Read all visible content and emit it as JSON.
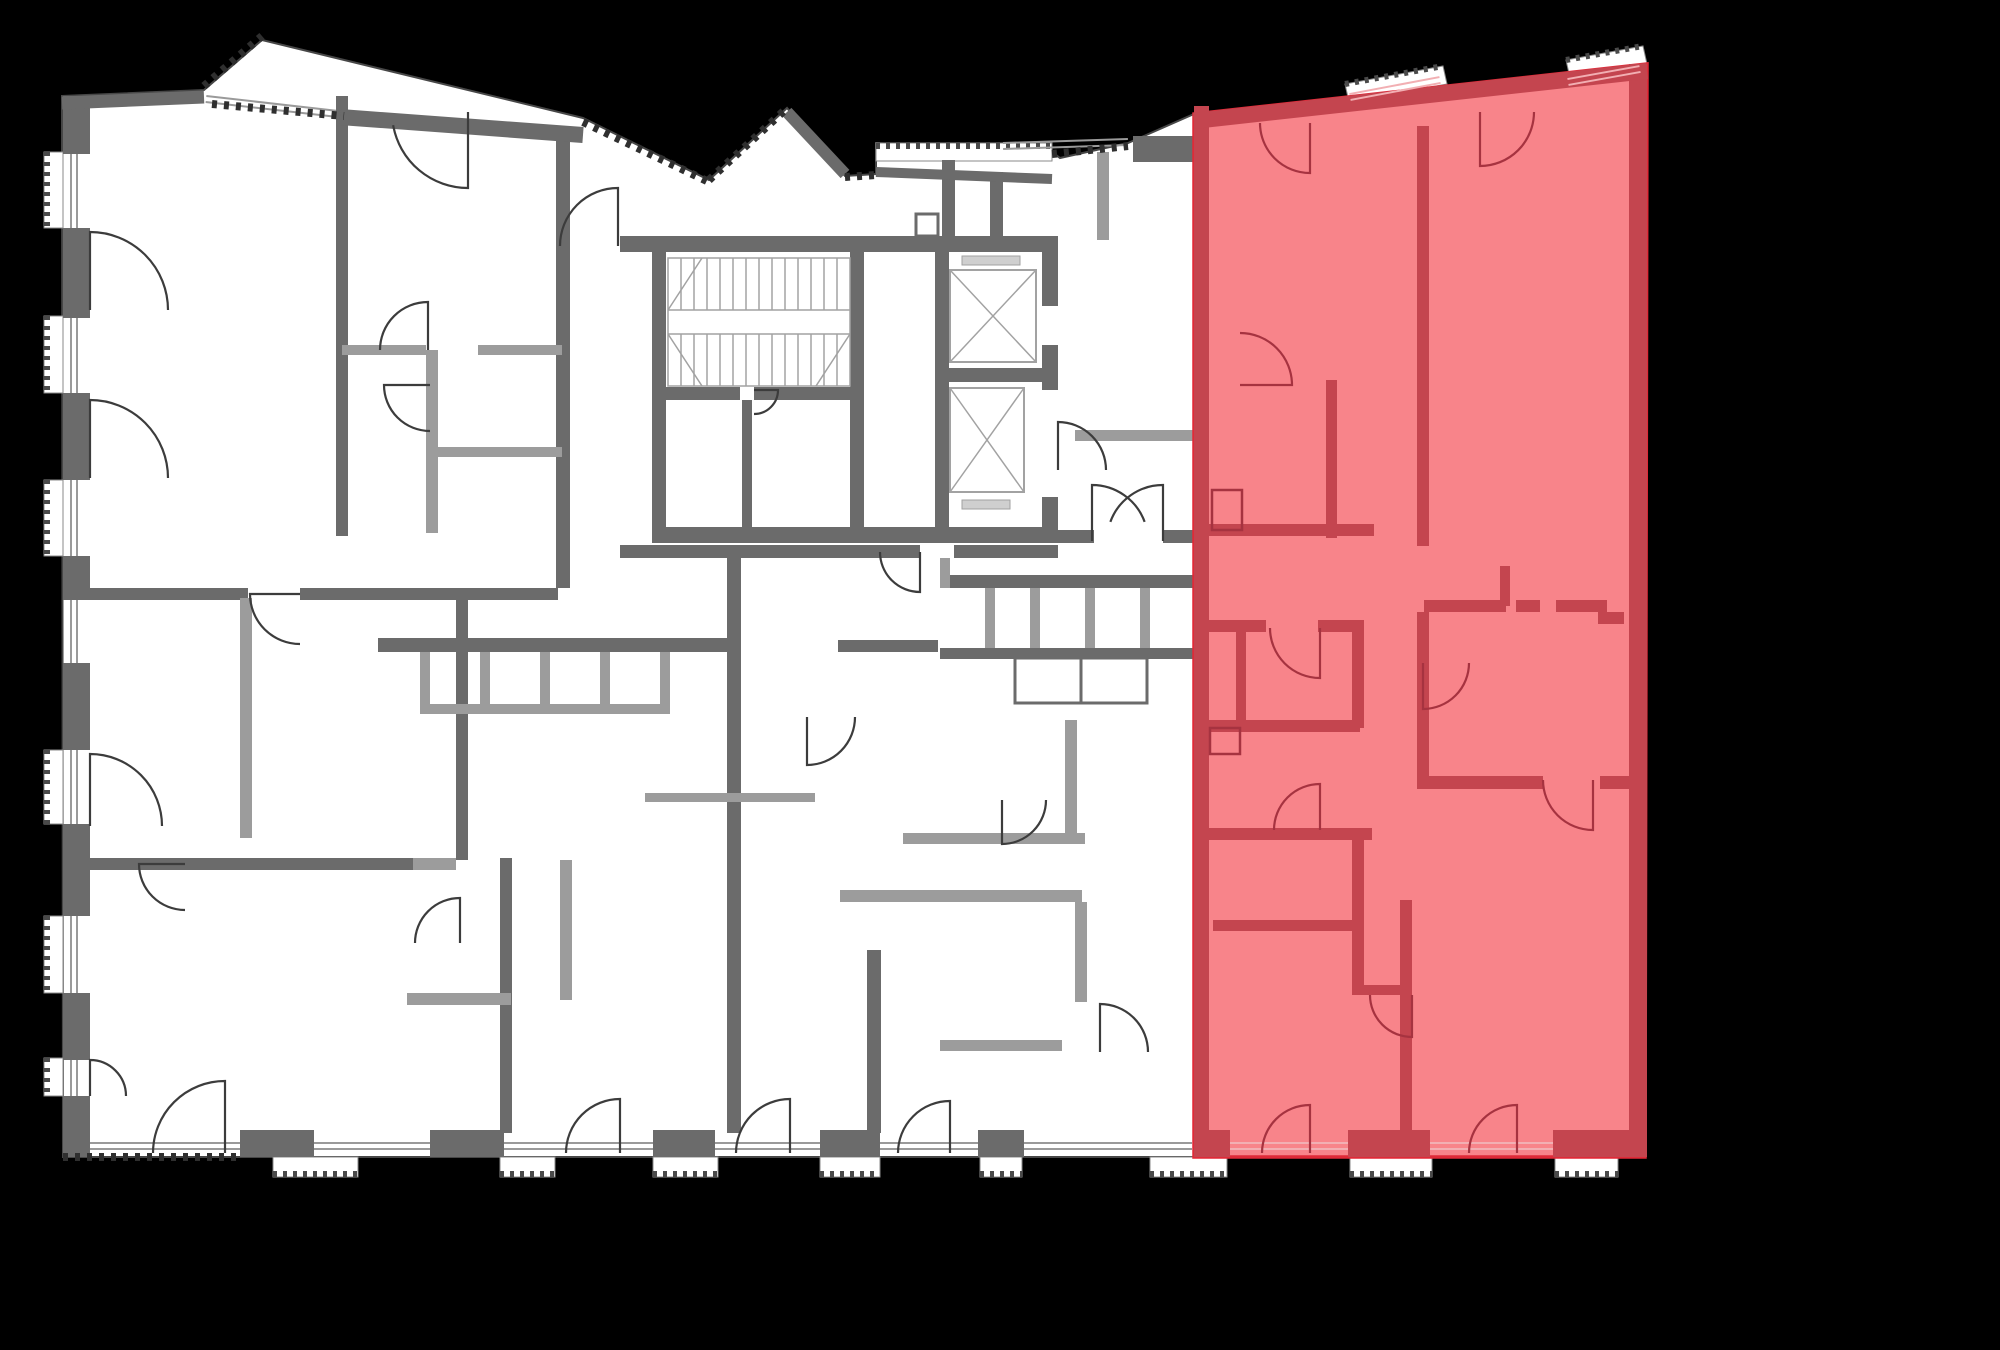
{
  "meta": {
    "title": "Residential building floor plan with selected apartment highlighted",
    "selected_unit_label": "selected-apartment",
    "canvas_width": 2000,
    "canvas_height": 1350
  },
  "palette": {
    "background": "#000000",
    "floor": "#ffffff",
    "outline": "#474747",
    "wall_dark": "#6b6b6b",
    "wall_light": "#9c9c9c",
    "glass": "#9a9a9a",
    "tick": "#2f2f2f",
    "balcony_tick": "#4a4a4a",
    "stair_line": "#a2a2a2",
    "door_line": "#3c3c3c",
    "hl_floor": "#F87F85",
    "hl_wall": "#C4454F",
    "hl_line": "#A63340",
    "hl_edge": "#E02A38",
    "hl_glass": "#F2AFB3"
  },
  "floor": {
    "outline": [
      [
        62,
        96
      ],
      [
        204,
        90
      ],
      [
        262,
        40
      ],
      [
        583,
        118
      ],
      [
        709,
        180
      ],
      [
        787,
        108
      ],
      [
        845,
        176
      ],
      [
        876,
        174
      ],
      [
        876,
        143
      ],
      [
        1052,
        152
      ],
      [
        1060,
        158
      ],
      [
        1128,
        143
      ],
      [
        1194,
        114
      ],
      [
        1647,
        64
      ],
      [
        1645,
        1157
      ],
      [
        63,
        1157
      ]
    ]
  },
  "walls": {
    "dark": [
      [
        63,
        96,
        27,
        58
      ],
      [
        63,
        228,
        27,
        90
      ],
      [
        63,
        393,
        27,
        87
      ],
      [
        63,
        556,
        27,
        36
      ],
      [
        63,
        663,
        27,
        87
      ],
      [
        63,
        824,
        27,
        92
      ],
      [
        63,
        993,
        27,
        67
      ],
      [
        63,
        1096,
        27,
        61
      ],
      [
        240,
        1130,
        74,
        27
      ],
      [
        430,
        1130,
        74,
        27
      ],
      [
        653,
        1130,
        62,
        27
      ],
      [
        820,
        1130,
        60,
        27
      ],
      [
        978,
        1130,
        46,
        27
      ],
      [
        620,
        236,
        438,
        16
      ],
      [
        652,
        252,
        14,
        275
      ],
      [
        850,
        252,
        14,
        275
      ],
      [
        652,
        527,
        406,
        16
      ],
      [
        652,
        387,
        88,
        13
      ],
      [
        754,
        387,
        96,
        13
      ],
      [
        742,
        400,
        10,
        127
      ],
      [
        935,
        252,
        14,
        275
      ],
      [
        1042,
        236,
        16,
        70
      ],
      [
        1042,
        345,
        16,
        45
      ],
      [
        1042,
        497,
        16,
        30
      ],
      [
        935,
        368,
        123,
        14
      ],
      [
        942,
        160,
        13,
        84
      ],
      [
        990,
        172,
        13,
        72
      ],
      [
        1133,
        136,
        60,
        26
      ],
      [
        620,
        545,
        300,
        13
      ],
      [
        954,
        545,
        104,
        13
      ],
      [
        1058,
        530,
        36,
        13
      ],
      [
        1163,
        530,
        31,
        13
      ],
      [
        727,
        558,
        14,
        575
      ],
      [
        336,
        96,
        12,
        440
      ],
      [
        556,
        128,
        14,
        460
      ],
      [
        456,
        598,
        12,
        262
      ],
      [
        500,
        858,
        12,
        275
      ],
      [
        867,
        950,
        14,
        183
      ],
      [
        378,
        638,
        352,
        14
      ],
      [
        838,
        640,
        100,
        12
      ],
      [
        940,
        575,
        254,
        13
      ],
      [
        940,
        648,
        254,
        11
      ],
      [
        63,
        588,
        185,
        12
      ],
      [
        300,
        588,
        258,
        12
      ],
      [
        63,
        858,
        350,
        12
      ]
    ],
    "light": [
      [
        342,
        345,
        84,
        10
      ],
      [
        478,
        345,
        84,
        10
      ],
      [
        426,
        350,
        12,
        183
      ],
      [
        432,
        447,
        130,
        10
      ],
      [
        240,
        598,
        12,
        240
      ],
      [
        407,
        993,
        104,
        12
      ],
      [
        560,
        860,
        12,
        140
      ],
      [
        413,
        858,
        43,
        12
      ],
      [
        985,
        588,
        10,
        60
      ],
      [
        1030,
        588,
        10,
        60
      ],
      [
        1085,
        588,
        10,
        60
      ],
      [
        1140,
        588,
        10,
        60
      ],
      [
        420,
        652,
        10,
        58
      ],
      [
        480,
        652,
        10,
        58
      ],
      [
        540,
        652,
        10,
        58
      ],
      [
        600,
        652,
        10,
        58
      ],
      [
        660,
        652,
        10,
        58
      ],
      [
        420,
        704,
        250,
        10
      ],
      [
        840,
        890,
        242,
        12
      ],
      [
        1075,
        902,
        12,
        100
      ],
      [
        903,
        833,
        182,
        11
      ],
      [
        1065,
        720,
        12,
        115
      ],
      [
        940,
        1040,
        122,
        11
      ],
      [
        1097,
        152,
        12,
        88
      ],
      [
        1075,
        430,
        119,
        11
      ],
      [
        645,
        793,
        170,
        9
      ],
      [
        940,
        558,
        10,
        30
      ]
    ],
    "thick_lines": [
      [
        62,
        103,
        204,
        97,
        13
      ],
      [
        340,
        117,
        583,
        135,
        16
      ],
      [
        787,
        112,
        845,
        174,
        12
      ],
      [
        876,
        172,
        1052,
        179,
        10
      ]
    ],
    "boxes": [
      [
        916,
        214,
        22,
        22
      ],
      [
        1015,
        658,
        66,
        45
      ],
      [
        1081,
        658,
        66,
        45
      ]
    ]
  },
  "openings": {
    "windows": [
      [
        74,
        152,
        74,
        228
      ],
      [
        74,
        316,
        74,
        393
      ],
      [
        74,
        480,
        74,
        556
      ],
      [
        74,
        592,
        74,
        663
      ],
      [
        74,
        750,
        74,
        824
      ],
      [
        74,
        916,
        74,
        993
      ],
      [
        74,
        1060,
        74,
        1096
      ],
      [
        206,
        99,
        338,
        114
      ],
      [
        1003,
        146,
        1128,
        142
      ],
      [
        90,
        1146,
        240,
        1146
      ],
      [
        314,
        1146,
        430,
        1146
      ],
      [
        504,
        1146,
        653,
        1146
      ],
      [
        715,
        1146,
        820,
        1146
      ],
      [
        880,
        1146,
        978,
        1146
      ],
      [
        1024,
        1146,
        1192,
        1146
      ]
    ]
  },
  "balconies": {
    "rects": [
      [
        44,
        152,
        19,
        76,
        "left"
      ],
      [
        44,
        316,
        19,
        77,
        "left"
      ],
      [
        44,
        480,
        19,
        76,
        "left"
      ],
      [
        44,
        750,
        19,
        74,
        "left"
      ],
      [
        44,
        916,
        19,
        77,
        "left"
      ],
      [
        44,
        1058,
        19,
        38,
        "left"
      ],
      [
        273,
        1157,
        85,
        20,
        "bottom"
      ],
      [
        500,
        1157,
        55,
        20,
        "bottom"
      ],
      [
        653,
        1157,
        65,
        20,
        "bottom"
      ],
      [
        820,
        1157,
        60,
        20,
        "bottom"
      ],
      [
        980,
        1157,
        42,
        20,
        "bottom"
      ],
      [
        1150,
        1157,
        77,
        20,
        "bottom"
      ],
      [
        1350,
        1157,
        82,
        20,
        "bottom"
      ],
      [
        1555,
        1157,
        63,
        20,
        "bottom"
      ],
      [
        876,
        143,
        176,
        18,
        "top"
      ]
    ],
    "quads": [
      [
        [
          1345,
          84
        ],
        [
          1443,
          66
        ],
        [
          1447,
          84
        ],
        [
          1349,
          102
        ]
      ],
      [
        [
          1566,
          60
        ],
        [
          1643,
          46
        ],
        [
          1647,
          64
        ],
        [
          1570,
          78
        ]
      ]
    ]
  },
  "ticks": [
    [
      204,
      86,
      262,
      36
    ],
    [
      212,
      104,
      344,
      116
    ],
    [
      583,
      122,
      709,
      182
    ],
    [
      709,
      180,
      787,
      108
    ],
    [
      845,
      177,
      876,
      175
    ],
    [
      1052,
      154,
      1128,
      146
    ],
    [
      63,
      1157,
      240,
      1157
    ]
  ],
  "stairs": {
    "x": 668,
    "y": 258,
    "w": 182,
    "flight": 52,
    "gap": 24,
    "treads": 13
  },
  "elevators": [
    {
      "inner": [
        950,
        270,
        86,
        92
      ],
      "sill": [
        962,
        256,
        58,
        9
      ]
    },
    {
      "inner": [
        950,
        388,
        74,
        104
      ],
      "sill": [
        962,
        500,
        48,
        9
      ]
    }
  ],
  "doors": {
    "gray": [
      {
        "h": [
          90,
          310
        ],
        "r": 78,
        "a": -90,
        "b": 0
      },
      {
        "h": [
          90,
          478
        ],
        "r": 78,
        "a": -90,
        "b": 0
      },
      {
        "h": [
          90,
          826
        ],
        "r": 72,
        "a": -90,
        "b": 0
      },
      {
        "h": [
          90,
          1096
        ],
        "r": 36,
        "a": -90,
        "b": 0
      },
      {
        "h": [
          468,
          112
        ],
        "r": 76,
        "a": 90,
        "b": 170
      },
      {
        "h": [
          618,
          246
        ],
        "r": 58,
        "a": -90,
        "b": 180
      },
      {
        "h": [
          428,
          350
        ],
        "r": 48,
        "a": -90,
        "b": 180
      },
      {
        "h": [
          430,
          385
        ],
        "r": 46,
        "a": 180,
        "b": 90
      },
      {
        "h": [
          920,
          552
        ],
        "r": 40,
        "a": 90,
        "b": 180
      },
      {
        "h": [
          1092,
          541
        ],
        "r": 56,
        "a": -90,
        "b": -20
      },
      {
        "h": [
          1163,
          541
        ],
        "r": 56,
        "a": -90,
        "b": 200
      },
      {
        "h": [
          300,
          594
        ],
        "r": 50,
        "a": 180,
        "b": 90
      },
      {
        "h": [
          185,
          864
        ],
        "r": 46,
        "a": 180,
        "b": 90
      },
      {
        "h": [
          460,
          943
        ],
        "r": 45,
        "a": -90,
        "b": 180
      },
      {
        "h": [
          225,
          1153
        ],
        "r": 72,
        "a": -90,
        "b": 180
      },
      {
        "h": [
          620,
          1153
        ],
        "r": 54,
        "a": -90,
        "b": 180
      },
      {
        "h": [
          790,
          1153
        ],
        "r": 54,
        "a": -90,
        "b": 180
      },
      {
        "h": [
          950,
          1153
        ],
        "r": 52,
        "a": -90,
        "b": 180
      },
      {
        "h": [
          807,
          717
        ],
        "r": 48,
        "a": 90,
        "b": 0
      },
      {
        "h": [
          1002,
          800
        ],
        "r": 44,
        "a": 90,
        "b": 0
      },
      {
        "h": [
          1100,
          1052
        ],
        "r": 48,
        "a": -90,
        "b": 0
      },
      {
        "h": [
          1058,
          470
        ],
        "r": 48,
        "a": -90,
        "b": 0
      },
      {
        "h": [
          754,
          390
        ],
        "r": 24,
        "a": 0,
        "b": 90
      }
    ],
    "red": [
      {
        "h": [
          1310,
          123
        ],
        "r": 50,
        "a": 90,
        "b": 180
      },
      {
        "h": [
          1480,
          112
        ],
        "r": 54,
        "a": 90,
        "b": 0
      },
      {
        "h": [
          1240,
          385
        ],
        "r": 52,
        "a": 0,
        "b": -90
      },
      {
        "h": [
          1320,
          628
        ],
        "r": 50,
        "a": 90,
        "b": 180
      },
      {
        "h": [
          1320,
          830
        ],
        "r": 46,
        "a": -90,
        "b": 180
      },
      {
        "h": [
          1423,
          663
        ],
        "r": 46,
        "a": 90,
        "b": 0
      },
      {
        "h": [
          1593,
          780
        ],
        "r": 50,
        "a": 90,
        "b": 180
      },
      {
        "h": [
          1412,
          995
        ],
        "r": 42,
        "a": 90,
        "b": 180
      },
      {
        "h": [
          1310,
          1153
        ],
        "r": 48,
        "a": -90,
        "b": 180
      },
      {
        "h": [
          1517,
          1153
        ],
        "r": 48,
        "a": -90,
        "b": 180
      }
    ]
  },
  "highlight": {
    "outline": [
      [
        1194,
        114
      ],
      [
        1647,
        64
      ],
      [
        1645,
        1157
      ],
      [
        1194,
        1157
      ]
    ],
    "walls": [
      [
        1194,
        106,
        15,
        1051
      ],
      [
        1629,
        64,
        18,
        1093
      ],
      [
        1417,
        126,
        12,
        420
      ],
      [
        1326,
        380,
        11,
        158
      ],
      [
        1200,
        524,
        174,
        12
      ],
      [
        1424,
        600,
        82,
        12
      ],
      [
        1516,
        600,
        24,
        12
      ],
      [
        1556,
        600,
        51,
        12
      ],
      [
        1500,
        566,
        10,
        40
      ],
      [
        1598,
        612,
        26,
        12
      ],
      [
        1417,
        612,
        12,
        168
      ],
      [
        1417,
        776,
        126,
        13
      ],
      [
        1600,
        776,
        29,
        13
      ],
      [
        1200,
        620,
        66,
        12
      ],
      [
        1318,
        620,
        46,
        12
      ],
      [
        1236,
        632,
        10,
        96
      ],
      [
        1352,
        620,
        12,
        108
      ],
      [
        1200,
        720,
        160,
        12
      ],
      [
        1200,
        828,
        172,
        12
      ],
      [
        1352,
        833,
        12,
        157
      ],
      [
        1352,
        985,
        60,
        10
      ],
      [
        1400,
        900,
        12,
        233
      ],
      [
        1213,
        920,
        146,
        11
      ],
      [
        1194,
        1130,
        36,
        27
      ],
      [
        1348,
        1130,
        82,
        27
      ],
      [
        1553,
        1130,
        74,
        27
      ],
      [
        1621,
        1130,
        26,
        27
      ]
    ],
    "thick_lines": [
      [
        1194,
        121,
        1647,
        71,
        16
      ]
    ],
    "boxes": [
      [
        1212,
        490,
        30,
        40
      ],
      [
        1210,
        728,
        30,
        26
      ]
    ],
    "windows": [
      [
        1350,
        97,
        1440,
        80
      ],
      [
        1568,
        82,
        1640,
        69
      ],
      [
        1230,
        1146,
        1348,
        1146
      ],
      [
        1430,
        1146,
        1553,
        1146
      ]
    ]
  }
}
